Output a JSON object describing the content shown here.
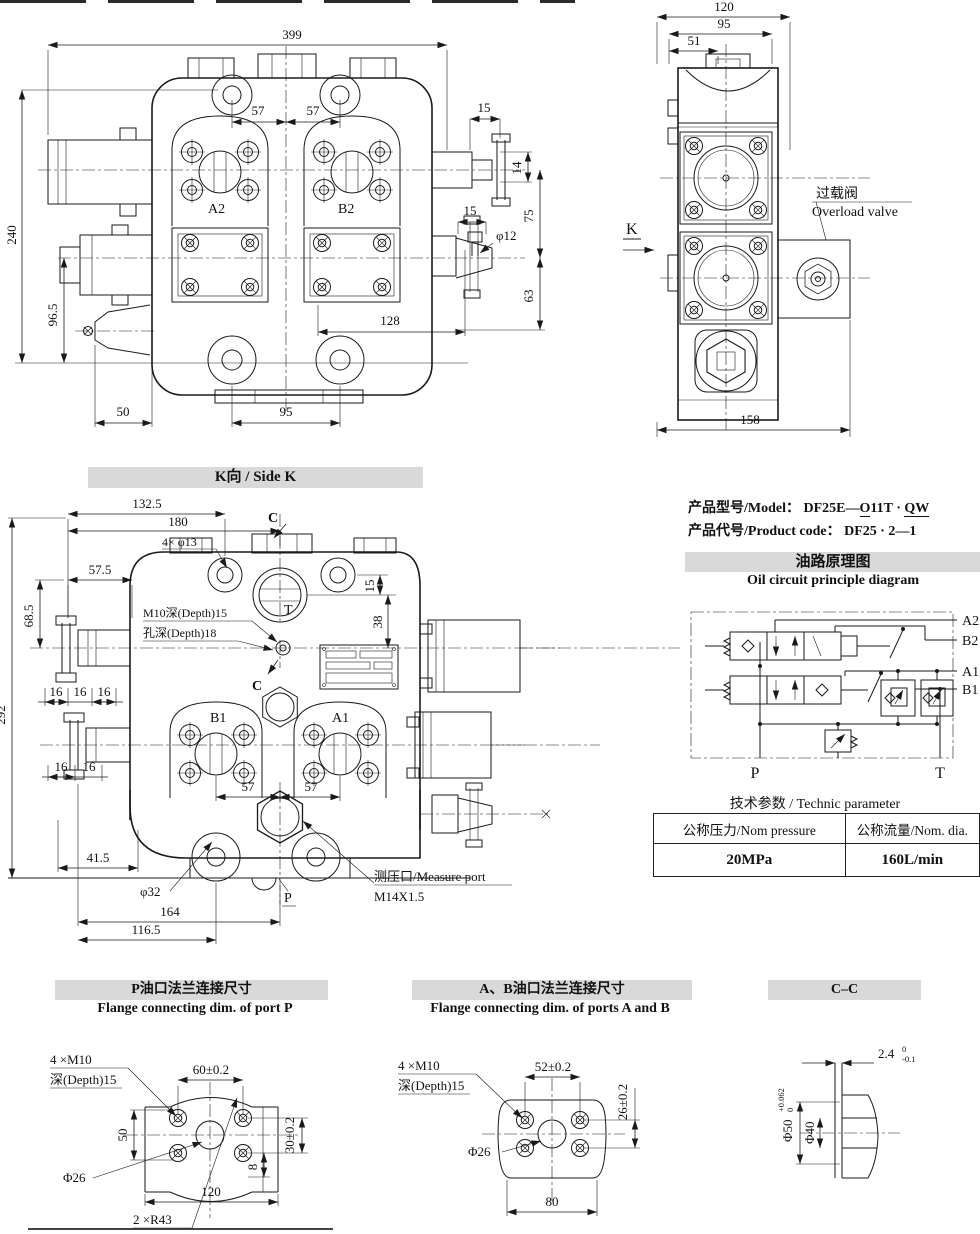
{
  "front_view": {
    "dim_399": "399",
    "dim_240": "240",
    "dim_96_5": "96.5",
    "dim_57l": "57",
    "dim_57r": "57",
    "dim_15_top": "15",
    "dim_14": "14",
    "dim_75": "75",
    "dim_63": "63",
    "dim_15_mid": "15",
    "dim_phi12": "φ12",
    "dim_128": "128",
    "dim_50": "50",
    "dim_95": "95",
    "label_a2": "A2",
    "label_b2": "B2"
  },
  "side_view": {
    "dim_120": "120",
    "dim_95": "95",
    "dim_51": "51",
    "dim_158": "158",
    "label_k": "K",
    "overload_cn": "过载阀",
    "overload_en": "Overload valve"
  },
  "k_view": {
    "title": "K向 / Side K",
    "dim_132_5": "132.5",
    "dim_180": "180",
    "note_4xphi13": "4× φ13",
    "dim_57_5": "57.5",
    "dim_68_5": "68.5",
    "dim_15": "15",
    "dim_38": "38",
    "dim_292": "292",
    "note_m10": "M10深(Depth)15",
    "note_hole_depth": "孔深(Depth)18",
    "dim_16": "16",
    "dim_41_5": "41.5",
    "dim_phi32": "φ32",
    "dim_164": "164",
    "dim_116_5": "116.5",
    "dim_57a": "57",
    "dim_57b": "57",
    "label_t": "T",
    "label_c": "C",
    "label_b1": "B1",
    "label_a1": "A1",
    "label_p": "P",
    "measure_port": "测压口/Measure port",
    "measure_thread": "M14X1.5"
  },
  "product": {
    "model_label": "产品型号/Model：",
    "model_p1": "DF25E—",
    "model_p2": "O",
    "model_p3": "11T · ",
    "model_p4": "QW",
    "code_label": "产品代号/Product code：",
    "code_value": "DF25 · 2—1"
  },
  "oil_circuit": {
    "title_cn": "油路原理图",
    "title_en": "Oil circuit principle diagram",
    "label_a2": "A2",
    "label_b2": "B2",
    "label_a1": "A1",
    "label_b1": "B1",
    "label_p": "P",
    "label_t": "T"
  },
  "tech_table": {
    "title": "技术参数 / Technic parameter",
    "col1_header": "公称压力/Nom pressure",
    "col2_header": "公称流量/Nom. dia.",
    "col1_value": "20MPa",
    "col2_value": "160L/min"
  },
  "flange_p": {
    "title_cn": "P油口法兰连接尺寸",
    "title_en": "Flange connecting dim.  of port P",
    "note_bolt": "4 ×M10",
    "note_depth": "深(Depth)15",
    "dim_60": "60±0.2",
    "dim_30": "30±0.2",
    "dim_50": "50",
    "dim_phi26": "Φ26",
    "dim_120": "120",
    "dim_8": "8",
    "note_r43": "2 ×R43"
  },
  "flange_ab": {
    "title_cn": "A、B油口法兰连接尺寸",
    "title_en": "Flange connecting dim. of ports A and B",
    "note_bolt": "4 ×M10",
    "note_depth": "深(Depth)15",
    "dim_52": "52±0.2",
    "dim_26": "26±0.2",
    "dim_phi26": "Φ26",
    "dim_80": "80"
  },
  "section_cc": {
    "title": "C–C",
    "dim_24": "2.4",
    "dim_24_up": "0",
    "dim_24_low": "-0.1",
    "dim_phi50": "Φ50",
    "dim_phi50_up": "+0.062",
    "dim_phi50_low": "0",
    "dim_phi40": "Φ40"
  }
}
